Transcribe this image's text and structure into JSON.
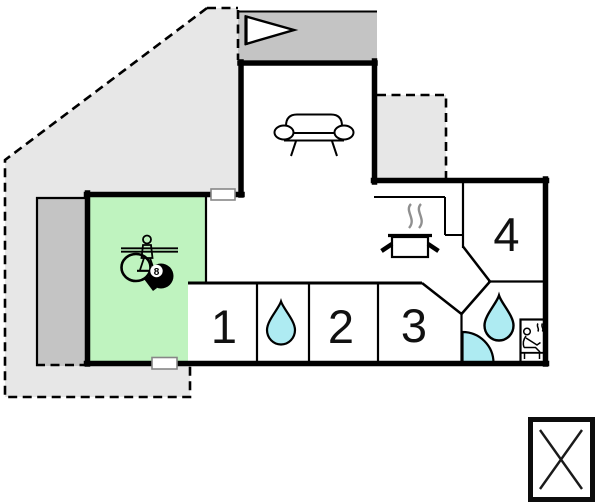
{
  "plan_title": "holiday-house-floor-plan",
  "rooms": {
    "bedroom1": {
      "number": "1"
    },
    "bedroom2": {
      "number": "2"
    },
    "bedroom3": {
      "number": "3"
    },
    "bedroom4": {
      "number": "4"
    }
  },
  "billiard_ball": {
    "label": "8"
  },
  "icons": {
    "flag-pennant-icon": "entrance flag pennant",
    "couch-icon": "sofa in living room",
    "pot-icon": "cooking pot with steam (kitchen)",
    "water-drop-icon-small": "water drop (bathroom between bedroom 1 and 2)",
    "water-drop-icon-large": "water drop (main bathroom)",
    "shower-icon": "corner shower quarter circle",
    "sauna-icon": "person in sauna with heat waves",
    "foosball-player-icon": "table football player",
    "table-tennis-paddle-icon": "table tennis paddle",
    "billiards-ball-icon": "8-ball",
    "crossed-box-icon": "box with diagonal cross (legend symbol)"
  },
  "colors": {
    "terrace": "#e7e7e7",
    "terrace_covered": "#c4c4c4",
    "activity_room": "#bff3bf",
    "water": "#aeebf2",
    "wall": "#000000",
    "steam": "#909090",
    "door_border": "#878787"
  }
}
